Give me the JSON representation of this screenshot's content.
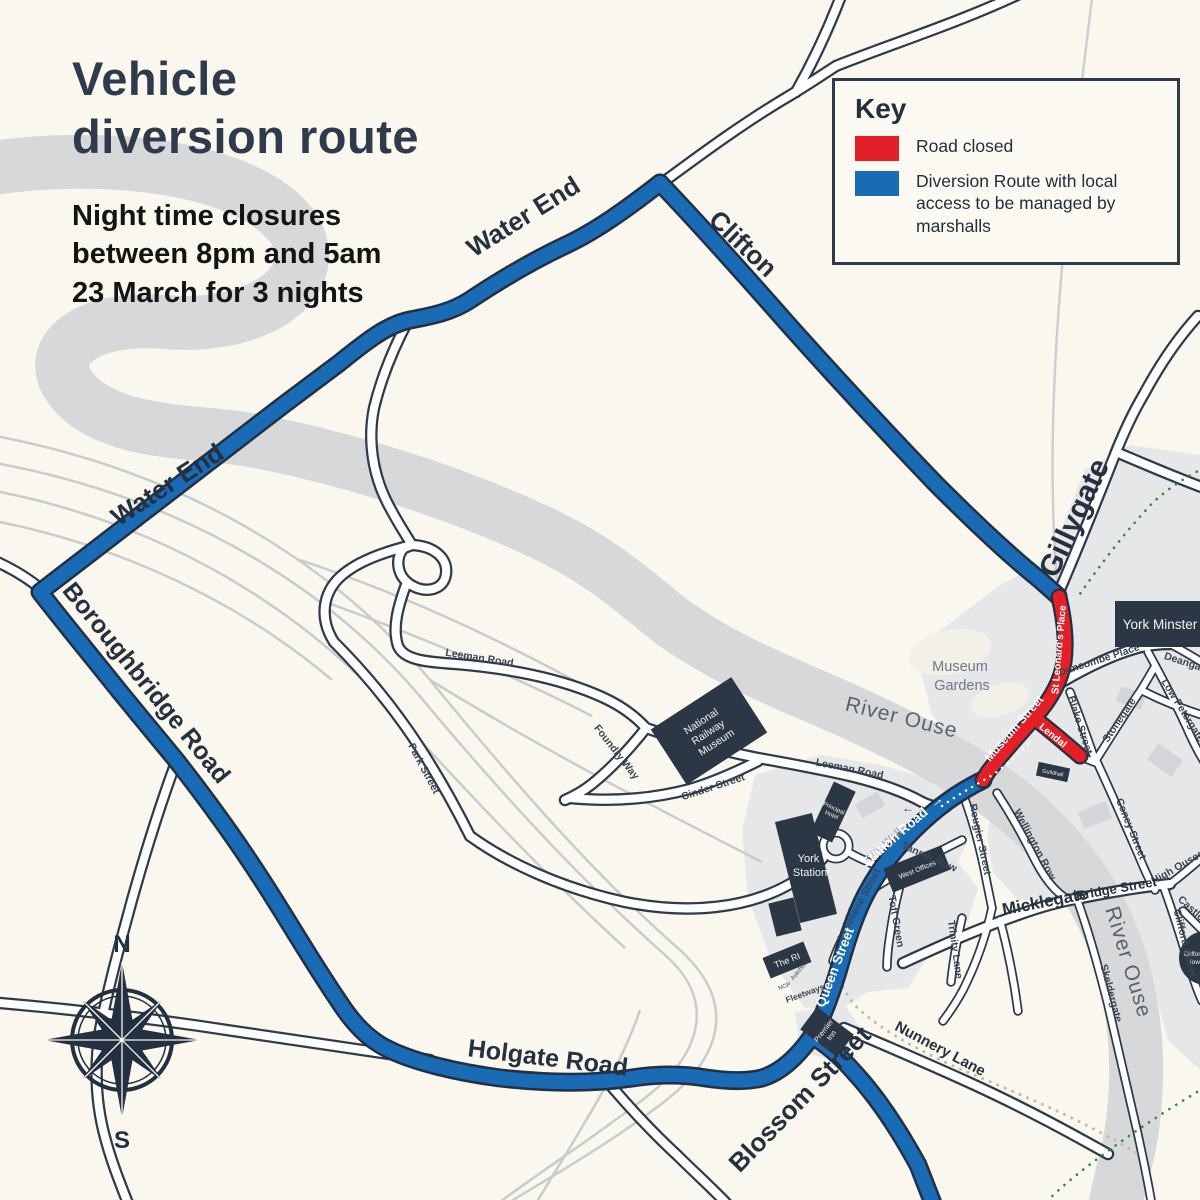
{
  "colors": {
    "background": "#FAF7EE",
    "river": "#D7D8DA",
    "road_casing": "#2E3B49",
    "diversion_blue": "#1A6BB5",
    "closed_red": "#E32028",
    "dark_navy": "#2B3744",
    "city_block": "#E6E7E8",
    "railway": "#C9CBCD",
    "walls_dotted_tan": "#C5BBA4",
    "walls_dotted_green": "#2F8A3C"
  },
  "header": {
    "title": [
      "Vehicle",
      "diversion route"
    ],
    "subtitle": [
      "Night time closures",
      "between 8pm and 5am",
      "23 March for 3 nights"
    ]
  },
  "key": {
    "title": "Key",
    "items": [
      {
        "color": "#E32028",
        "label": "Road closed"
      },
      {
        "color": "#1A6BB5",
        "label": "Diversion Route with local access to be managed by marshalls"
      }
    ]
  },
  "compass": {
    "north": "N",
    "south": "S"
  },
  "icons": {
    "one_way_left": "←",
    "route_arrow": "→"
  },
  "labels": {
    "route": {
      "water_end": "Water End",
      "clifton": "Clifton",
      "boroughbridge_road": "Boroughbridge Road",
      "holgate_road": "Holgate Road",
      "blossom_street": "Blossom Street",
      "gillygate": "Gillygate",
      "queen_street": "Queen Street",
      "station_road": "Station Road"
    },
    "closed": {
      "museum_street": "Museum Street",
      "st_leonards_place": "St Leonard's Place",
      "lendal": "Lendal"
    },
    "streets": {
      "leeman_road": "Leeman Road",
      "park_street": "Park Street",
      "foundry_way": "Foundry Way",
      "cinder_street": "Cinder Street",
      "rougier_street": "Rougier Street",
      "tanner_row": "Tanner Row",
      "wellington_row": "Wellington Row",
      "toft_green": "Toft Green",
      "loverose_street": "Loverose Street",
      "trinity_lane": "Trinity Lane",
      "duncombe_place": "Duncombe Place",
      "blake_street": "Blake Street",
      "stonegate": "Stonegate",
      "deangate": "Deangate",
      "low_petergate": "Low Petergate",
      "coney_street": "Coney Street",
      "high_ousegate": "High Ousegate",
      "clifford_street": "Clifford Street",
      "castlegate": "Castlegate",
      "skeldergate": "Skeldergate",
      "micklegate": "Micklegate",
      "bridge_street": "Bridge Street",
      "nunnery_lane": "Nunnery Lane",
      "city_walls": "City Walls"
    },
    "areas": {
      "river_ouse": "River Ouse",
      "museum_gardens": [
        "Museum",
        "Gardens"
      ]
    }
  },
  "pois": {
    "york_minster": "York Minster",
    "national_railway_museum": [
      "National",
      "Railway",
      "Museum"
    ],
    "york_station": [
      "York",
      "Station"
    ],
    "principal_hotel": [
      "Principal",
      "Hotel"
    ],
    "west_offices": "West Offices",
    "guildhall": "Guildhall",
    "premier_inn": [
      "Premier",
      "Inn"
    ],
    "the_ri": "The RI",
    "cliffords_tower": [
      "Clifford's",
      "Tower"
    ],
    "fleetways": "Fleetways",
    "ncp": "NCP",
    "autohorn": "Autohorn"
  }
}
